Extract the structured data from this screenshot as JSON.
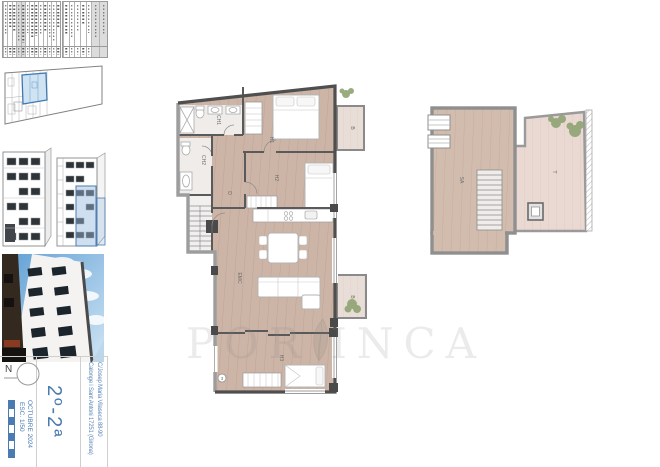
{
  "accent": "#4a7cb2",
  "title_block": {
    "north_label": "N",
    "scale": "ESC. 1/50",
    "date": "OCTUBRE 2024",
    "unit": "2º-2ª",
    "address_line1": "C/Josep Maria Vilaseca 88-90",
    "address_line2": "Calonge i Sant Antoni 17251 (Girona)"
  },
  "watermark": {
    "left": "POR",
    "right": "INCA",
    "full": "PORFINCA"
  },
  "main_plan": {
    "rooms": [
      {
        "id": "ch1",
        "label": "CH1"
      },
      {
        "id": "ch2",
        "label": "CH2"
      },
      {
        "id": "h1",
        "label": "H1"
      },
      {
        "id": "h2",
        "label": "H2"
      },
      {
        "id": "d",
        "label": "D"
      },
      {
        "id": "emc",
        "label": "EMC"
      },
      {
        "id": "h3",
        "label": "H3"
      },
      {
        "id": "b1",
        "label": "B"
      },
      {
        "id": "b2",
        "label": "B"
      },
      {
        "id": "num3",
        "label": "3"
      }
    ]
  },
  "roof_plan": {
    "rooms": [
      {
        "id": "sa",
        "label": "SA"
      },
      {
        "id": "t",
        "label": "T"
      }
    ]
  }
}
